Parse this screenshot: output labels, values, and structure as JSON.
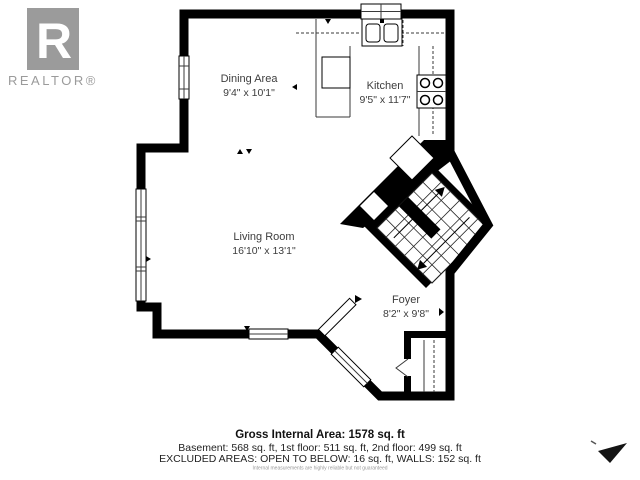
{
  "logo": {
    "letter": "R",
    "label": "REALTOR®"
  },
  "rooms": {
    "dining": {
      "name": "Dining Area",
      "dims": "9'4\" x 10'1\""
    },
    "kitchen": {
      "name": "Kitchen",
      "dims": "9'5\" x 11'7\""
    },
    "living": {
      "name": "Living Room",
      "dims": "16'10\" x 13'1\""
    },
    "foyer": {
      "name": "Foyer",
      "dims": "8'2\" x 9'8\""
    }
  },
  "summary": {
    "gross": "Gross Internal Area: 1578 sq. ft",
    "floors": "Basement: 568 sq. ft, 1st floor: 511 sq. ft, 2nd floor: 499 sq. ft",
    "excluded": "EXCLUDED AREAS: OPEN TO BELOW: 16 sq. ft, WALLS: 152 sq. ft",
    "disclaimer": "Internal measurements are highly reliable but not guaranteed"
  },
  "colors": {
    "wall": "#000000",
    "label_text": "#3d3d3d",
    "logo_gray": "#9b9b9b"
  }
}
